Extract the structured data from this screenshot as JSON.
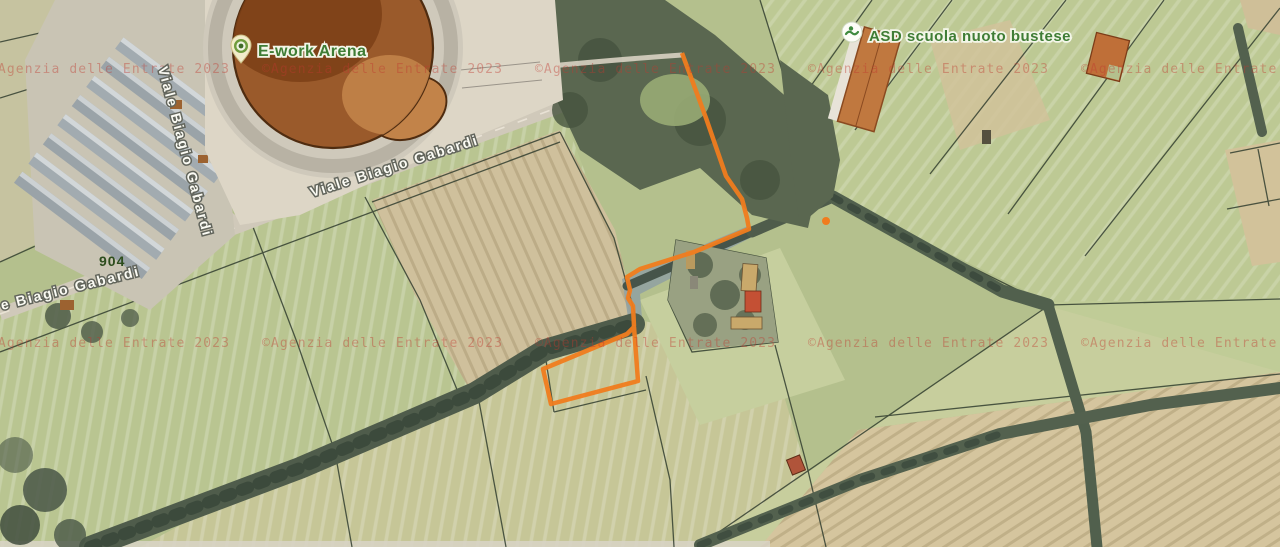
{
  "map": {
    "pois": [
      {
        "label": "E-work Arena"
      },
      {
        "label": "ASD scuola nuoto bustese"
      }
    ],
    "road_labels": [
      {
        "label": "Viale Biagio Gabardi"
      },
      {
        "label": "Viale Biagio Gabardi"
      },
      {
        "label": "e Biagio Gabardi"
      }
    ],
    "parcel_number": "904",
    "watermark": {
      "text": "©Agenzia delle Entrate 2023",
      "color": "#c0392f"
    },
    "selection": {
      "color": "#f07c1e"
    },
    "poi_label_color": "#3f7d35"
  }
}
